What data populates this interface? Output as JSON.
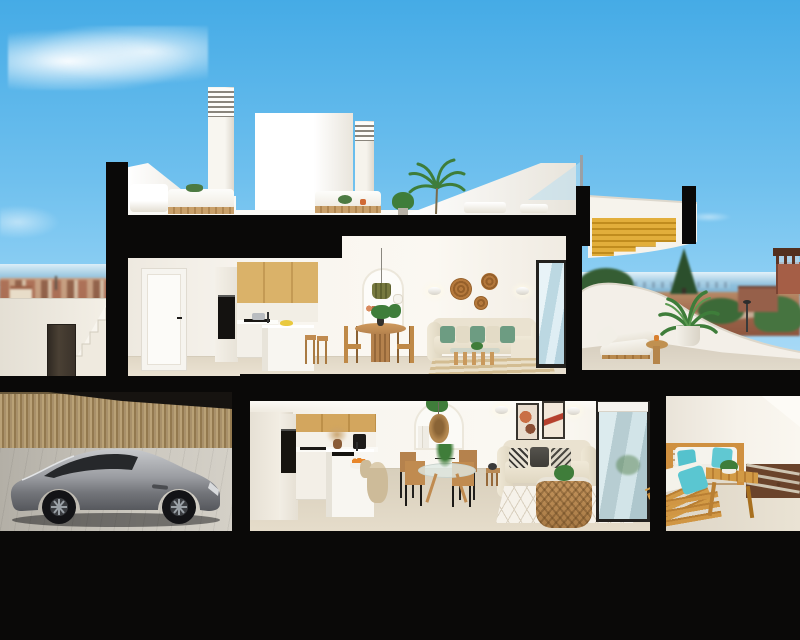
{
  "scene": {
    "description": "Photorealistic 3D architectural cross-section rendering of a two-storey coastal duplex home; cut-away dollhouse view with black section pochee, blue sky, wispy cloud, distant sea, terracotta town and fields",
    "time_of_day": "day",
    "visible_text": "none"
  },
  "palette": {
    "sky_top": "#45abe6",
    "sky_horizon": "#cfeafa",
    "section_cut_black": "#0a0908",
    "wall_white": "#f7f4ee",
    "floor_tile": "#ddd4c2",
    "oak_cabinet": "#d8b069",
    "wood_furniture": "#bf8947",
    "stair_gold_wood": "#d9a433",
    "sofa_cream": "#eae2d0",
    "pillow_green": "#6d9c82",
    "pillow_teal": "#55c2cd",
    "car_silver": "#9fa1a6",
    "fence_timber": "#b49a6f",
    "sea": "#8fc0dc",
    "terracotta_town": "#a96b52",
    "plant_green": "#3e7d3a"
  },
  "rooftop": {
    "label": "roof terrace",
    "objects": [
      "chimney-with-vent-grille",
      "second-chimney-vent",
      "white-roof-volume",
      "white-outdoor-lounge-sofas",
      "planter-boxes",
      "potted-palm",
      "white-sun-loungers",
      "sloped-white-parapet",
      "glass-balustrade"
    ]
  },
  "upper_floor": {
    "label": "upper floor apartment",
    "kitchen": [
      "white-interior-door",
      "tall-oven-column",
      "oak-upper-cabinets",
      "white-base-cabinets",
      "induction-hob-with-pot",
      "white-island",
      "yellow-fruit-bowl",
      "two-wood-stools"
    ],
    "dining": [
      "round-oak-pedestal-table",
      "four-wicker-wood-chairs",
      "olive-green-pendant-lamp",
      "arched-shelf-niche-with-vases-and-plant"
    ],
    "living": [
      "cream-corner-sofa",
      "green-and-cream-cushions",
      "three-wicker-wall-plates",
      "two-wall-sconces",
      "glass-wood-coffee-table",
      "striped-beige-rug",
      "sliding-glass-door"
    ]
  },
  "upper_terrace": {
    "label": "upper sea-view terrace",
    "objects": [
      "two-wood-sun-loungers",
      "round-wood-side-table-with-candle",
      "potted-palm",
      "curved-white-parapet"
    ]
  },
  "right_stair": {
    "objects": [
      "section-cut-stair-with-golden-wood-treads",
      "white-curved-stringer"
    ]
  },
  "lower_floor": {
    "label": "ground floor apartment",
    "driveway": [
      "silver-sports-coupe",
      "timber-slat-fence",
      "paved-forecourt"
    ],
    "kitchen": [
      "oak-upper-cabinets",
      "black-wall-oven",
      "coffee-machine",
      "pampas-vase",
      "white-island-with-black-sink",
      "orange-fruit-bowl",
      "rattan-barrel-stool"
    ],
    "dining": [
      "round-glass-table",
      "four-wood-chairs-black-legs",
      "arched-shelf-niche",
      "rattan-pendant-lamp",
      "trailing-plant"
    ],
    "living": [
      "cream-two-seat-sofa",
      "patterned-and-charcoal-cushions",
      "two-framed-abstract-artworks",
      "two-wall-sconces",
      "rattan-basket-coffee-table",
      "white-diamond-lattice-rug",
      "dark-framed-sliding-glass-door",
      "wood-side-stool"
    ]
  },
  "lower_patio": {
    "label": "rear patio",
    "objects": [
      "wood-slat-outdoor-sofa",
      "angled-wood-lounger",
      "teal-outdoor-cushions",
      "wood-slat-coffee-bench",
      "gravel-bed-with-concrete-strips",
      "white-garden-wall"
    ]
  },
  "background": {
    "left": [
      "wispy-cloud",
      "sea-horizon",
      "terracotta-hill-town",
      "white-exterior-stair-wall",
      "dark-side-door"
    ],
    "right": [
      "sea-horizon-with-distant-city",
      "pine-and-leafy-trees",
      "russet-fields-and-road",
      "watch-tower",
      "terracotta-buildings",
      "street-lamp"
    ]
  }
}
